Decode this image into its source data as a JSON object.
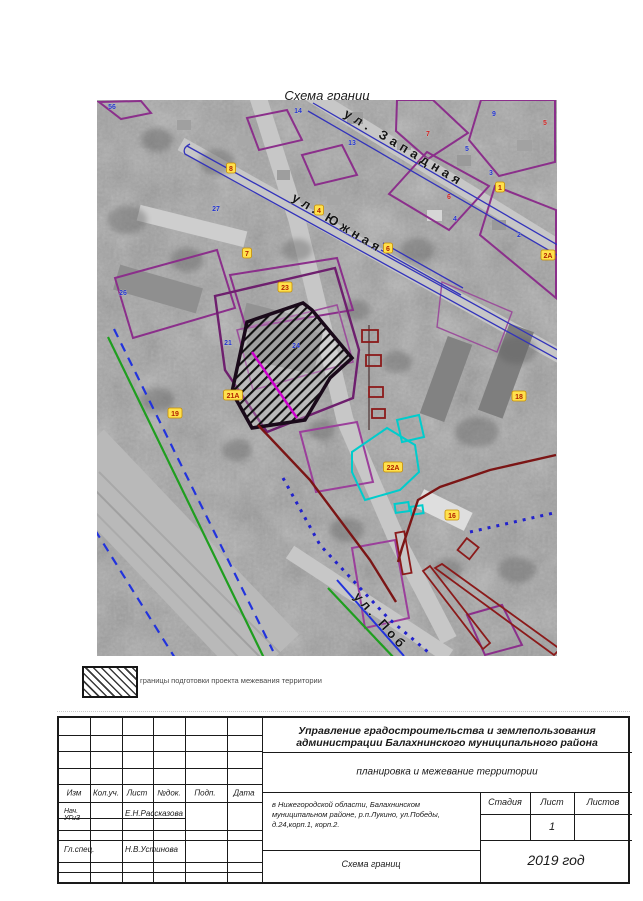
{
  "page_title": "Схема границ",
  "map": {
    "streets": [
      {
        "name": "ул.  Западная",
        "x": 246,
        "y": 16,
        "rotate": 31,
        "spacing": 4.5,
        "size": 13
      },
      {
        "name": "ул.  Южная",
        "x": 194,
        "y": 100,
        "rotate": 31,
        "spacing": 4,
        "size": 13
      },
      {
        "name": "ул.  Поб",
        "x": 256,
        "y": 497,
        "rotate": 48,
        "spacing": 3.5,
        "size": 13
      }
    ],
    "point_labels": [
      {
        "t": "56",
        "c": "blue",
        "x": 15,
        "y": 6
      },
      {
        "t": "14",
        "c": "blue",
        "x": 201,
        "y": 10
      },
      {
        "t": "13",
        "c": "blue",
        "x": 255,
        "y": 42
      },
      {
        "t": "9",
        "c": "blue",
        "x": 397,
        "y": 13
      },
      {
        "t": "5",
        "c": "blue",
        "x": 370,
        "y": 48
      },
      {
        "t": "3",
        "c": "blue",
        "x": 394,
        "y": 72
      },
      {
        "t": "4",
        "c": "blue",
        "x": 358,
        "y": 118
      },
      {
        "t": "2",
        "c": "blue",
        "x": 422,
        "y": 134
      },
      {
        "t": "27",
        "c": "blue",
        "x": 119,
        "y": 108
      },
      {
        "t": "26",
        "c": "blue",
        "x": 26,
        "y": 192
      },
      {
        "t": "21",
        "c": "blue",
        "x": 131,
        "y": 242
      },
      {
        "t": "24",
        "c": "blue",
        "x": 199,
        "y": 245
      },
      {
        "t": "7",
        "c": "red",
        "x": 331,
        "y": 33
      },
      {
        "t": "5",
        "c": "red",
        "x": 448,
        "y": 22
      },
      {
        "t": "6",
        "c": "red",
        "x": 352,
        "y": 96
      },
      {
        "t": "8",
        "c": "yellow",
        "x": 134,
        "y": 68
      },
      {
        "t": "7",
        "c": "yellow",
        "x": 150,
        "y": 153
      },
      {
        "t": "4",
        "c": "yellow",
        "x": 222,
        "y": 110
      },
      {
        "t": "6",
        "c": "yellow",
        "x": 291,
        "y": 148
      },
      {
        "t": "1",
        "c": "yellow",
        "x": 403,
        "y": 87
      },
      {
        "t": "23",
        "c": "yellow",
        "x": 188,
        "y": 187
      },
      {
        "t": "2А",
        "c": "yellow",
        "x": 451,
        "y": 155
      },
      {
        "t": "21А",
        "c": "yellow",
        "x": 136,
        "y": 295
      },
      {
        "t": "22А",
        "c": "yellow",
        "x": 296,
        "y": 367
      },
      {
        "t": "18",
        "c": "yellow",
        "x": 422,
        "y": 296
      },
      {
        "t": "16",
        "c": "yellow",
        "x": 355,
        "y": 415
      },
      {
        "t": "19",
        "c": "yellow",
        "x": 78,
        "y": 313
      }
    ]
  },
  "legend": {
    "swatch": "diagonal-hatch",
    "text": "границы подготовки проекта межевания территории"
  },
  "title_block": {
    "org_line1": "Управление градостроительства и землепользования",
    "org_line2": "администрации Балахнинского муниципального района",
    "subtitle": "планировка и межевание территории",
    "columns": {
      "c1": "Изм",
      "c2": "Кол.уч.",
      "c3": "Лист",
      "c4": "№док.",
      "c5": "Подп.",
      "c6": "Дата"
    },
    "sig1_role1": "Нач.",
    "sig1_role2": "УГиЗ",
    "sig1_name": "Е.Н.Рассказова",
    "sig2_role": "Гл.спец.",
    "sig2_name": "Н.В.Устинова",
    "address_line1": "в Нижегородской области, Балахнинском",
    "address_line2": "муниципальном районе, р.п.Лукино, ул.Победы,",
    "address_line3": "д.24,корп.1, корп.2.",
    "stage_label": "Стадия",
    "sheet_label": "Лист",
    "sheets_label": "Листов",
    "sheet_value": "1",
    "doc_name": "Схема границ",
    "year": "2019 год"
  },
  "colors": {
    "parcel_purple": "#8b2f8b",
    "street_blue": "#3333bb",
    "project_outline": "#1a0a1a",
    "magenta_line": "#cc00cc",
    "cyan_outline": "#00cccc",
    "dark_red": "#8b1a1a",
    "green_line": "#1f9e1f",
    "dashed_blue": "#2233dd",
    "label_blue": "#2233cc",
    "label_red": "#cc2222",
    "label_yellow_bg": "#ffe14d"
  }
}
